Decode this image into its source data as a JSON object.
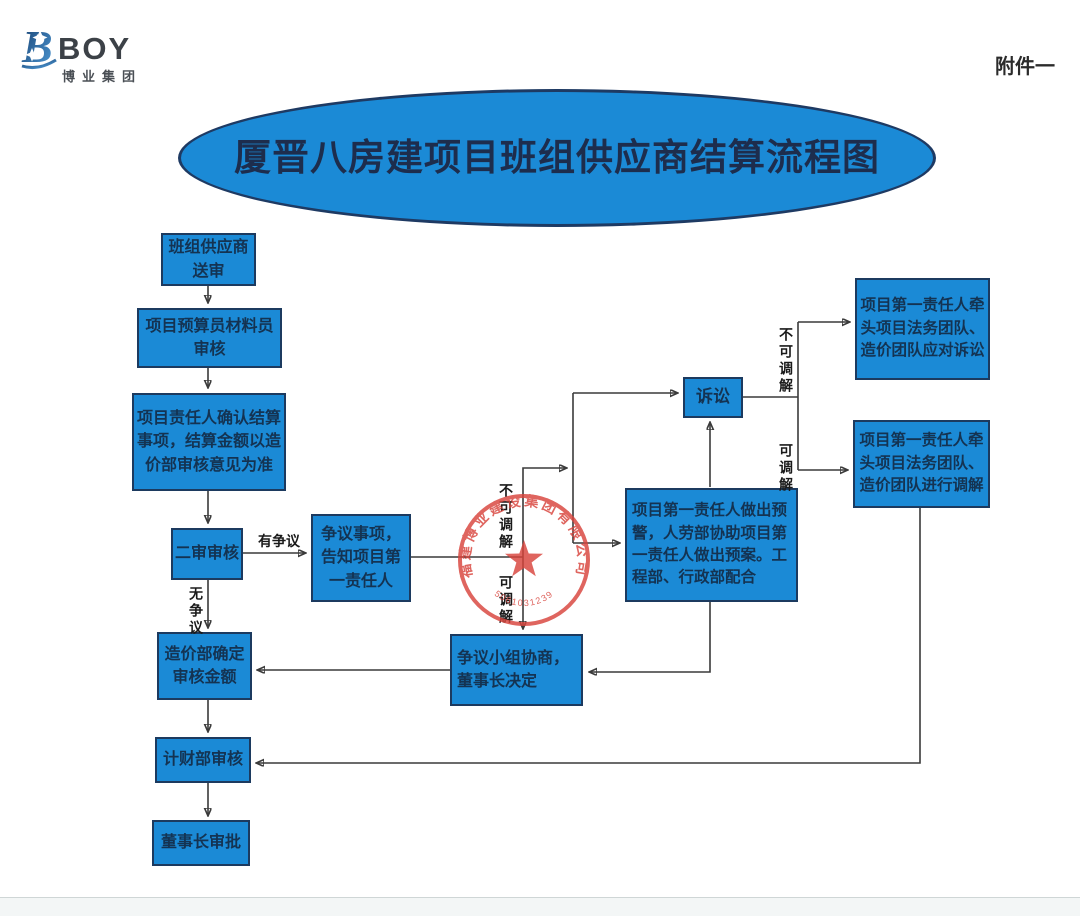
{
  "page": {
    "attachment_label": "附件一",
    "title": "厦晋八房建项目班组供应商结算流程图",
    "logo": {
      "letter": "B",
      "brand": "BOY",
      "subtitle": "博业集团"
    }
  },
  "colors": {
    "box_fill": "#1b8ad6",
    "box_border": "#1c3a5f",
    "box_text": "#143352",
    "title_text": "#1d2d4d",
    "stamp_red": "#d8443c",
    "connector_line": "#3a3a3a"
  },
  "nodes": {
    "submit": "班组供应商\n送审",
    "budget_material_review": "项目预算员材料员\n审核",
    "confirm_settlement": "项目责任人确认结算\n事项，结算金额以造\n价部审核意见为准",
    "second_review": "二审审核",
    "dispute_notify": "争议事项，\n告知项目第\n一责任人",
    "cost_dept_amount": "造价部确定\n审核金额",
    "finance_review": "计财部审核",
    "chairman_approval": "董事长审批",
    "dispute_group": "争议小组协商，\n董事长决定",
    "warning_plan": "项目第一责任人做出预\n警，人劳部协助项目第\n一责任人做出预案。工\n程部、行政部配合",
    "litigation": "诉讼",
    "respond_litigation": "项目第一责任人牵\n头项目法务团队、\n造价团队应对诉讼",
    "conduct_mediation": "项目第一责任人牵\n头项目法务团队、\n造价团队进行调解"
  },
  "edge_labels": {
    "has_dispute": "有争议",
    "no_dispute": "无争议",
    "not_mediable": "不可调解",
    "mediable": "可调解"
  },
  "stamp": {
    "company": "福建博业建设集团有限公司",
    "number": "350610312392"
  }
}
